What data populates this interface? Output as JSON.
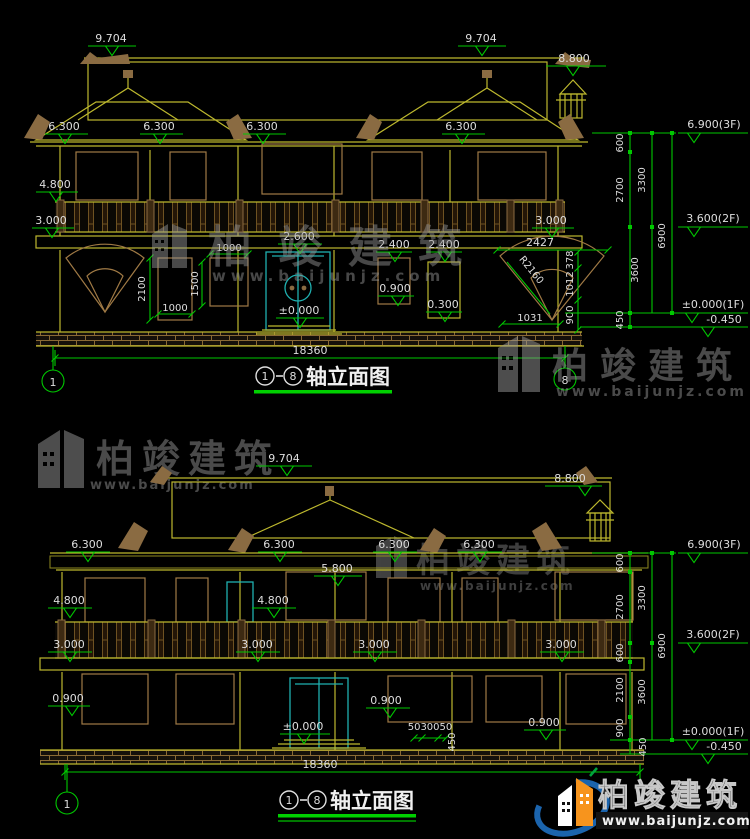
{
  "brand": {
    "name": "柏竣建筑",
    "url": "www.baijunjz.com"
  },
  "logo": {
    "name": "柏竣建筑",
    "url": "www.baijunjz.com"
  },
  "top_view": {
    "title_full": "①-⑧轴立面图",
    "title_axis_start": "1",
    "title_axis_end": "8",
    "title_text": "轴立面图",
    "axis_left": "1",
    "axis_right": "8",
    "total_width": "18360",
    "levels": {
      "ridge_left": "9.704",
      "ridge_right": "9.704",
      "turret": "8.800",
      "eave": [
        "6.300",
        "6.300",
        "6.300",
        "6.300"
      ],
      "balcony": "4.800",
      "awning_left": "3.000",
      "awning_right": "3.000",
      "door_top": "2.600",
      "door_base": "±0.000",
      "win_d_top": "2.400",
      "win_e_top": "2.400",
      "win_d_sill": "0.900",
      "win_e_sill": "0.300"
    },
    "dims": {
      "win_b_height": "2100",
      "win_b_width": "1000",
      "win_c_width": "1000",
      "win_c_height": "1500",
      "fan_top": "2427",
      "fan_radius": "R2160",
      "fan_seg1": "378",
      "fan_seg2": "1012",
      "fan_seg3": "900",
      "fan_bottom": "1031"
    },
    "col": {
      "lv_3f": "6.900(3F)",
      "lv_2f": "3.600(2F)",
      "lv_1f": "±0.000(1F)",
      "lv_base": "-0.450",
      "s600": "600",
      "s2700": "2700",
      "s3300": "3300",
      "s3600": "3600",
      "s6900": "6900",
      "s450": "450"
    }
  },
  "bottom_view": {
    "title_full": "①-⑧轴立面图",
    "title_axis_start": "1",
    "title_axis_end": "8",
    "title_text": "轴立面图",
    "axis_left": "1",
    "total_width": "18360",
    "levels": {
      "ridge": "9.704",
      "turret": "8.800",
      "eave": [
        "6.300",
        "6.300",
        "6.300",
        "6.300"
      ],
      "door2f_top": "5.800",
      "balcony": [
        "4.800",
        "4.800"
      ],
      "awning": [
        "3.000",
        "3.000",
        "3.000",
        "3.000"
      ],
      "sill": [
        "0.900",
        "0.900",
        "0.900"
      ],
      "door_base": "±0.000"
    },
    "dims": {
      "steps": "5030050",
      "step_height": "450"
    },
    "col": {
      "lv_3f": "6.900(3F)",
      "lv_2f": "3.600(2F)",
      "lv_1f": "±0.000(1F)",
      "lv_base": "-0.450",
      "s600a": "600",
      "s2700": "2700",
      "s3300": "3300",
      "s600b": "600",
      "s2100": "2100",
      "s900": "900",
      "s450": "450",
      "s3600": "3600",
      "s6900": "6900"
    }
  }
}
